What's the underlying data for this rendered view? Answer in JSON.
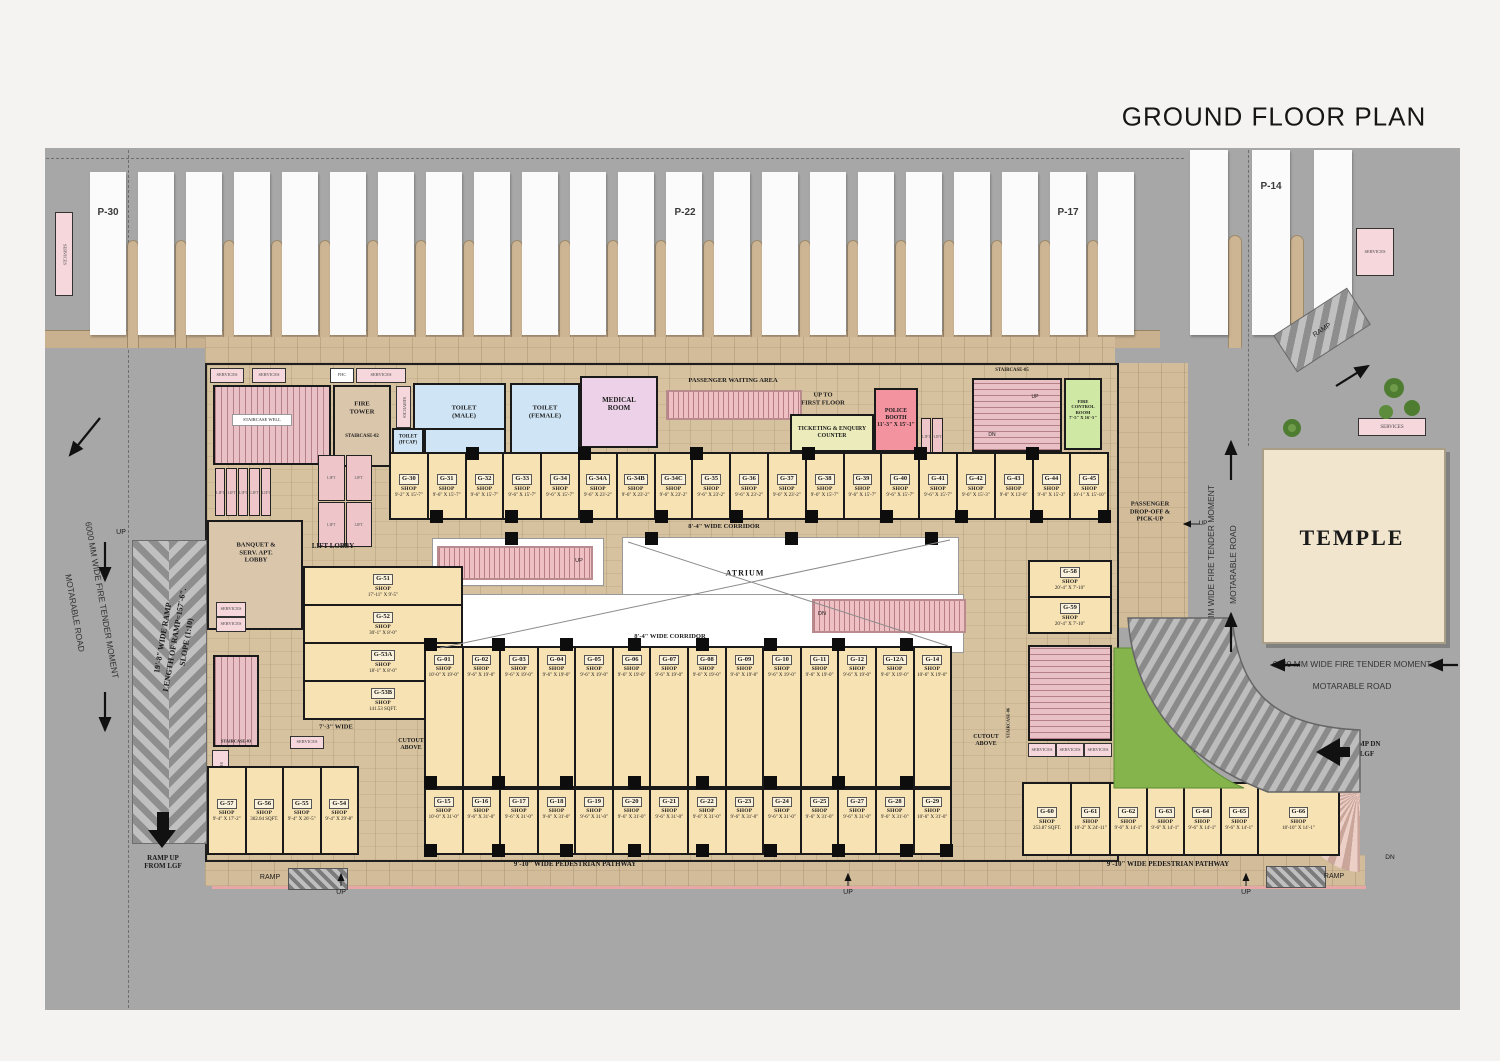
{
  "title": "GROUND FLOOR PLAN",
  "parking": {
    "p30": "P-30",
    "p22": "P-22",
    "p17": "P-17",
    "p14": "P-14"
  },
  "roads": {
    "fire_tender": "6000 MM WIDE FIRE TENDER MOMENT",
    "motarable": "MOTARABLE ROAD"
  },
  "ramps": {
    "width_line": "19'-8\" WIDE RAMP",
    "length_line": "LENGTH OF RAMP=157'-6\".",
    "slope_line": "SLOPE (1:10)",
    "ramp_word": "RAMP",
    "up_from_lgf_l1": "RAMP UP",
    "up_from_lgf_l2": "FROM LGF",
    "dn_to_lgf_l1": "RAMP DN",
    "dn_to_lgf_l2": "TO LGF"
  },
  "temple": {
    "name": "TEMPLE"
  },
  "atrium": {
    "name": "ATRIUM"
  },
  "corridors": {
    "top": "8'-4\" WIDE CORRIDOR",
    "bottom": "8'-4\" WIDE CORRIDOR"
  },
  "pathway": {
    "label": "9'-10\" WIDE PEDESTRIAN PATHWAY"
  },
  "dropoff": {
    "l1": "PASSENGER",
    "l2": "DROP-OFF &",
    "l3": "PICK-UP"
  },
  "waiting": {
    "label": "PASSENGER WAITING AREA"
  },
  "up_first": {
    "l1": "UP TO",
    "l2": "FIRST FLOOR"
  },
  "rooms": {
    "fire_tower_l1": "FIRE",
    "fire_tower_l2": "TOWER",
    "fire_tower_stair": "STAIRCASE-02",
    "staircase_well": "STAIRCASE WELL",
    "staircase_03": "STAIRCASE-03",
    "staircase_05": "STAIRCASE-05",
    "staircase_06": "STAIRCASE-06",
    "toilet_male_l1": "TOILET",
    "toilet_male_l2": "(MALE)",
    "toilet_female_l1": "TOILET",
    "toilet_female_l2": "(FEMALE)",
    "toilet_hcap_l1": "TOILET",
    "toilet_hcap_l2": "(H'CAP)",
    "medical_l1": "MEDICAL",
    "medical_l2": "ROOM",
    "ticketing_l1": "TICKETING & ENQUIRY",
    "ticketing_l2": "COUNTER",
    "police_l1": "POLICE",
    "police_l2": "BOOTH",
    "police_dim": "11'-3\" X 15'-1\"",
    "fire_control_l1": "FIRE",
    "fire_control_l2": "CONTROL",
    "fire_control_l3": "ROOM",
    "fire_control_dim": "7'-5\" X 16'-5\"",
    "banquet_l1": "BANQUET &",
    "banquet_l2": "SERV. APT.",
    "banquet_l3": "LOBBY",
    "lift_lobby": "LIFT LOBBY",
    "passage_l1": "PASSAGE",
    "passage_l2": "7'-3\" WIDE",
    "cutout_l1": "CUTOUT",
    "cutout_l2": "ABOVE",
    "services": "SERVICES",
    "fhc": "FHC",
    "lift": "LIFT",
    "up": "UP",
    "dn": "DN"
  },
  "shops": {
    "label_word": "SHOP",
    "top_row": [
      {
        "id": "G-30",
        "dim": "9'-2\" X 15'-7\""
      },
      {
        "id": "G-31",
        "dim": "9'-6\" X 15'-7\""
      },
      {
        "id": "G-32",
        "dim": "9'-6\" X 15'-7\""
      },
      {
        "id": "G-33",
        "dim": "9'-6\" X 15'-7\""
      },
      {
        "id": "G-34",
        "dim": "9'-6\" X 15'-7\""
      },
      {
        "id": "G-34A",
        "dim": "9'-6\" X 23'-2\""
      },
      {
        "id": "G-34B",
        "dim": "9'-6\" X 23'-2\""
      },
      {
        "id": "G-34C",
        "dim": "9'-6\" X 23'-2\""
      },
      {
        "id": "G-35",
        "dim": "9'-6\" X 23'-2\""
      },
      {
        "id": "G-36",
        "dim": "9'-6\" X 23'-2\""
      },
      {
        "id": "G-37",
        "dim": "9'-6\" X 23'-2\""
      },
      {
        "id": "G-38",
        "dim": "9'-6\" X 15'-7\""
      },
      {
        "id": "G-39",
        "dim": "9'-6\" X 15'-7\""
      },
      {
        "id": "G-40",
        "dim": "9'-6\" X 15'-7\""
      },
      {
        "id": "G-41",
        "dim": "9'-6\" X 15'-7\""
      },
      {
        "id": "G-42",
        "dim": "9'-6\" X 15'-3\""
      },
      {
        "id": "G-43",
        "dim": "9'-6\" X 13'-0\""
      },
      {
        "id": "G-44",
        "dim": "9'-6\" X 15'-3\""
      },
      {
        "id": "G-45",
        "dim": "10'-1\" X 15'-10\""
      }
    ],
    "mid_row": [
      {
        "id": "G-01",
        "dim": "10'-0\" X 19'-0\""
      },
      {
        "id": "G-02",
        "dim": "9'-6\" X 19'-0\""
      },
      {
        "id": "G-03",
        "dim": "9'-6\" X 19'-0\""
      },
      {
        "id": "G-04",
        "dim": "9'-6\" X 19'-0\""
      },
      {
        "id": "G-05",
        "dim": "9'-6\" X 19'-0\""
      },
      {
        "id": "G-06",
        "dim": "9'-6\" X 19'-0\""
      },
      {
        "id": "G-07",
        "dim": "9'-6\" X 19'-0\""
      },
      {
        "id": "G-08",
        "dim": "9'-6\" X 19'-0\""
      },
      {
        "id": "G-09",
        "dim": "9'-6\" X 19'-0\""
      },
      {
        "id": "G-10",
        "dim": "9'-6\" X 19'-0\""
      },
      {
        "id": "G-11",
        "dim": "9'-6\" X 19'-0\""
      },
      {
        "id": "G-12",
        "dim": "9'-6\" X 19'-0\""
      },
      {
        "id": "G-12A",
        "dim": "9'-6\" X 19'-0\""
      },
      {
        "id": "G-14",
        "dim": "10'-6\" X 19'-0\""
      }
    ],
    "bottom_row": [
      {
        "id": "G-15",
        "dim": "10'-0\" X 31'-0\""
      },
      {
        "id": "G-16",
        "dim": "9'-6\" X 31'-0\""
      },
      {
        "id": "G-17",
        "dim": "9'-6\" X 31'-0\""
      },
      {
        "id": "G-18",
        "dim": "9'-6\" X 31'-0\""
      },
      {
        "id": "G-19",
        "dim": "9'-6\" X 31'-0\""
      },
      {
        "id": "G-20",
        "dim": "9'-6\" X 31'-0\""
      },
      {
        "id": "G-21",
        "dim": "9'-6\" X 31'-0\""
      },
      {
        "id": "G-22",
        "dim": "9'-6\" X 31'-0\""
      },
      {
        "id": "G-23",
        "dim": "9'-6\" X 31'-0\""
      },
      {
        "id": "G-24",
        "dim": "9'-6\" X 31'-0\""
      },
      {
        "id": "G-25",
        "dim": "9'-6\" X 31'-0\""
      },
      {
        "id": "G-27",
        "dim": "9'-6\" X 31'-0\""
      },
      {
        "id": "G-28",
        "dim": "9'-6\" X 31'-0\""
      },
      {
        "id": "G-29",
        "dim": "10'-6\" X 31'-0\""
      }
    ],
    "left_mid": [
      {
        "id": "G-51",
        "dim": "17'-11\" X 9'-5\""
      },
      {
        "id": "G-52",
        "dim": "30'-1\" X 8'-0\""
      },
      {
        "id": "G-53A",
        "dim": "18'-1\" X 8'-0\""
      },
      {
        "id": "G-53B",
        "dim": "141.53 SQFT."
      }
    ],
    "left_col": [
      {
        "id": "G-57",
        "dim": "9'-4\" X 17'-2\""
      },
      {
        "id": "G-56",
        "dim": "302.04 SQFT."
      },
      {
        "id": "G-55",
        "dim": "9'-4\" X 26'-5\""
      },
      {
        "id": "G-54",
        "dim": "9'-4\" X 29'-8\""
      }
    ],
    "right_pair": [
      {
        "id": "G-58",
        "dim": "20'-4\" X 7'-10\""
      },
      {
        "id": "G-59",
        "dim": "20'-4\" X 7'-10\""
      }
    ],
    "right_bottom": [
      {
        "id": "G-60",
        "dim": "253.87 SQFT.",
        "f": 1.25
      },
      {
        "id": "G-61",
        "dim": "10'-2\" X 24'-11\"",
        "f": 1
      },
      {
        "id": "G-62",
        "dim": "9'-6\" X 14'-1\"",
        "f": 0.95
      },
      {
        "id": "G-63",
        "dim": "9'-6\" X 14'-1\"",
        "f": 0.95
      },
      {
        "id": "G-64",
        "dim": "9'-6\" X 14'-1\"",
        "f": 0.95
      },
      {
        "id": "G-65",
        "dim": "9'-6\" X 14'-1\"",
        "f": 0.95
      },
      {
        "id": "G-66",
        "dim": "18'-10\" X 14'-1\"",
        "f": 2.15
      }
    ]
  }
}
